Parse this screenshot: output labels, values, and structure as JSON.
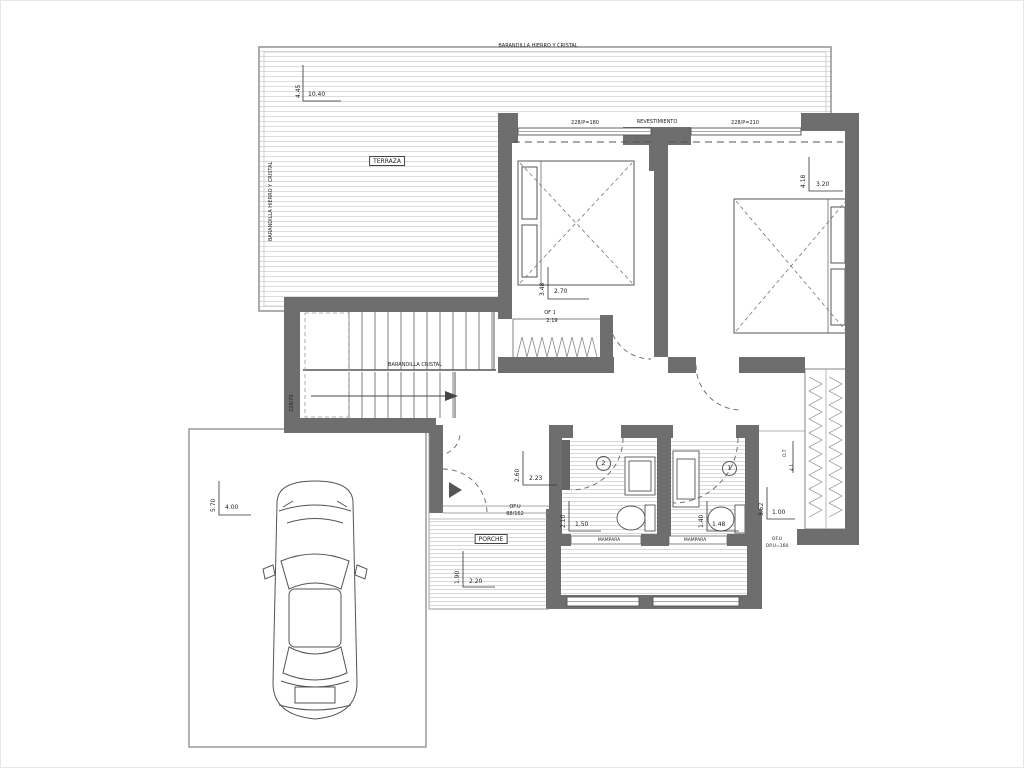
{
  "plan": {
    "railing_top": "BARANDILLA HIERRO Y CRISTAL",
    "railing_left": "BARANDILLA HIERRO Y CRISTAL",
    "railing_stairs": "BARANDILLA CRISTAL",
    "terrace": "TERRAZA",
    "porch": "PORCHE",
    "cladding": "REVESTIMIENTO",
    "window_left": "228/P=180",
    "window_right": "228/P=210",
    "mampara_1": "MAMPARA",
    "mampara_2": "MAMPARA",
    "bath2_num": "2",
    "bath1_num": "1",
    "of1": "OF 1",
    "of1_dim": "2.19",
    "ofu_entry": "OF.U",
    "ofu_entry_dim": "88/162",
    "ofu_right": "OF.U",
    "ofu_right_dim": "OP.U=160",
    "stair_dim": "228/70",
    "closet_label": "O.T",
    "closet_dim": "4.1"
  },
  "dims": {
    "terrace_v": "4.45",
    "terrace_h": "10.40",
    "bed1_v": "3.48",
    "bed1_h": "2.70",
    "bed2_v": "4.18",
    "bed2_h": "3.20",
    "hall_v": "2.60",
    "hall_h": "2.23",
    "porch_v": "1.90",
    "porch_h": "2.20",
    "bath2_v": "2.10",
    "bath2_h": "1.50",
    "bath1_v": "1.40",
    "bath1_h": "1.48",
    "dress_v": "3.52",
    "dress_h": "1.00",
    "garage_v": "5.70",
    "garage_h": "4.00"
  }
}
